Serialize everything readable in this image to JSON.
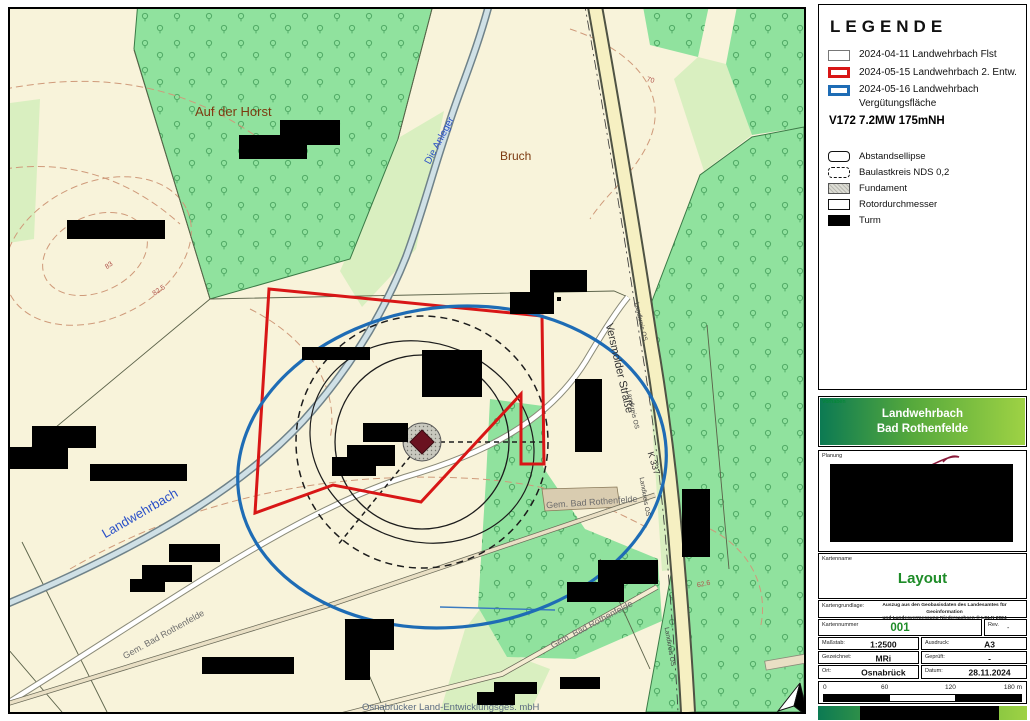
{
  "legend": {
    "title": "LEGENDE",
    "items": [
      {
        "label": "2024-04-11 Landwehrbach Flst"
      },
      {
        "label": "2024-05-15 Landwehrbach 2. Entw."
      },
      {
        "label": "2024-05-16 Landwehrbach",
        "label2": "Vergütungsfläche"
      }
    ],
    "turbine_spec": "V172 7.2MW 175mNH",
    "symbols": [
      {
        "label": "Abstandsellipse"
      },
      {
        "label": "Baulastkreis NDS 0,2"
      },
      {
        "label": "Fundament"
      },
      {
        "label": "Rotordurchmesser"
      },
      {
        "label": "Turm"
      }
    ]
  },
  "title_block": {
    "vorhaben_label": "Vorhaben",
    "vorhaben_line1": "Landwehrbach",
    "vorhaben_line2": "Bad Rothenfelde",
    "planung_label": "Planung",
    "kartenname_label": "Kartenname",
    "kartenname_value": "Layout",
    "kartengrundlage_label": "Kartengrundlage:",
    "kartengrundlage_line1": "Auszug aus den Geobasisdaten des Landesamtes für Geoinformation",
    "kartengrundlage_line2": "und Landesvermessung Niedersachsen © LGLN 2024",
    "kartennummer_label": "Kartennummer",
    "kartennummer_value": "001",
    "rev_label": "Rev.",
    "rev_value": "-",
    "massstab_label": "Maßstab:",
    "massstab_value": "1:2500",
    "ausdruck_label": "Ausdruck:",
    "ausdruck_value": "A3",
    "gezeichnet_label": "Gezeichnet:",
    "gezeichnet_value": "MRi",
    "geprueft_label": "Geprüft:",
    "geprueft_value": "-",
    "ort_label": "Ort:",
    "ort_value": "Osnabrück",
    "datum_label": "Datum:",
    "datum_value": "28.11.2024",
    "scale_ticks": {
      "t0": "0",
      "t1": "60",
      "t2": "120",
      "t3": "180 m"
    }
  },
  "map": {
    "labels": {
      "auf_der_horst": "Auf der Horst",
      "bruch": "Bruch",
      "die_anleger": "Die Anleger",
      "landwehrbach": "Landwehrbach",
      "gem_bad_rothenfelde": "Gem. Bad Rothenfelde",
      "versmolder_strasse": "Versmolder Straße",
      "landkreis_os": "Landkreis OS",
      "k337": "K 337",
      "credit": "Osnabrücker Land-Entwicklungsges. mbH",
      "north": "N"
    },
    "contour_labels": {
      "c83": "83",
      "c82_5": "82.5",
      "c70": "70",
      "c62_6": "62.6"
    }
  },
  "colors": {
    "boundary_red": "#d81616",
    "boundary_blue": "#1e6cb5",
    "forest_green": "#90e29e",
    "light_green": "#d9efc0",
    "map_cream": "#f8f3da",
    "gradient_dark": "#0c7a53",
    "gradient_light": "#9ed244",
    "value_green": "#1e8c28"
  }
}
